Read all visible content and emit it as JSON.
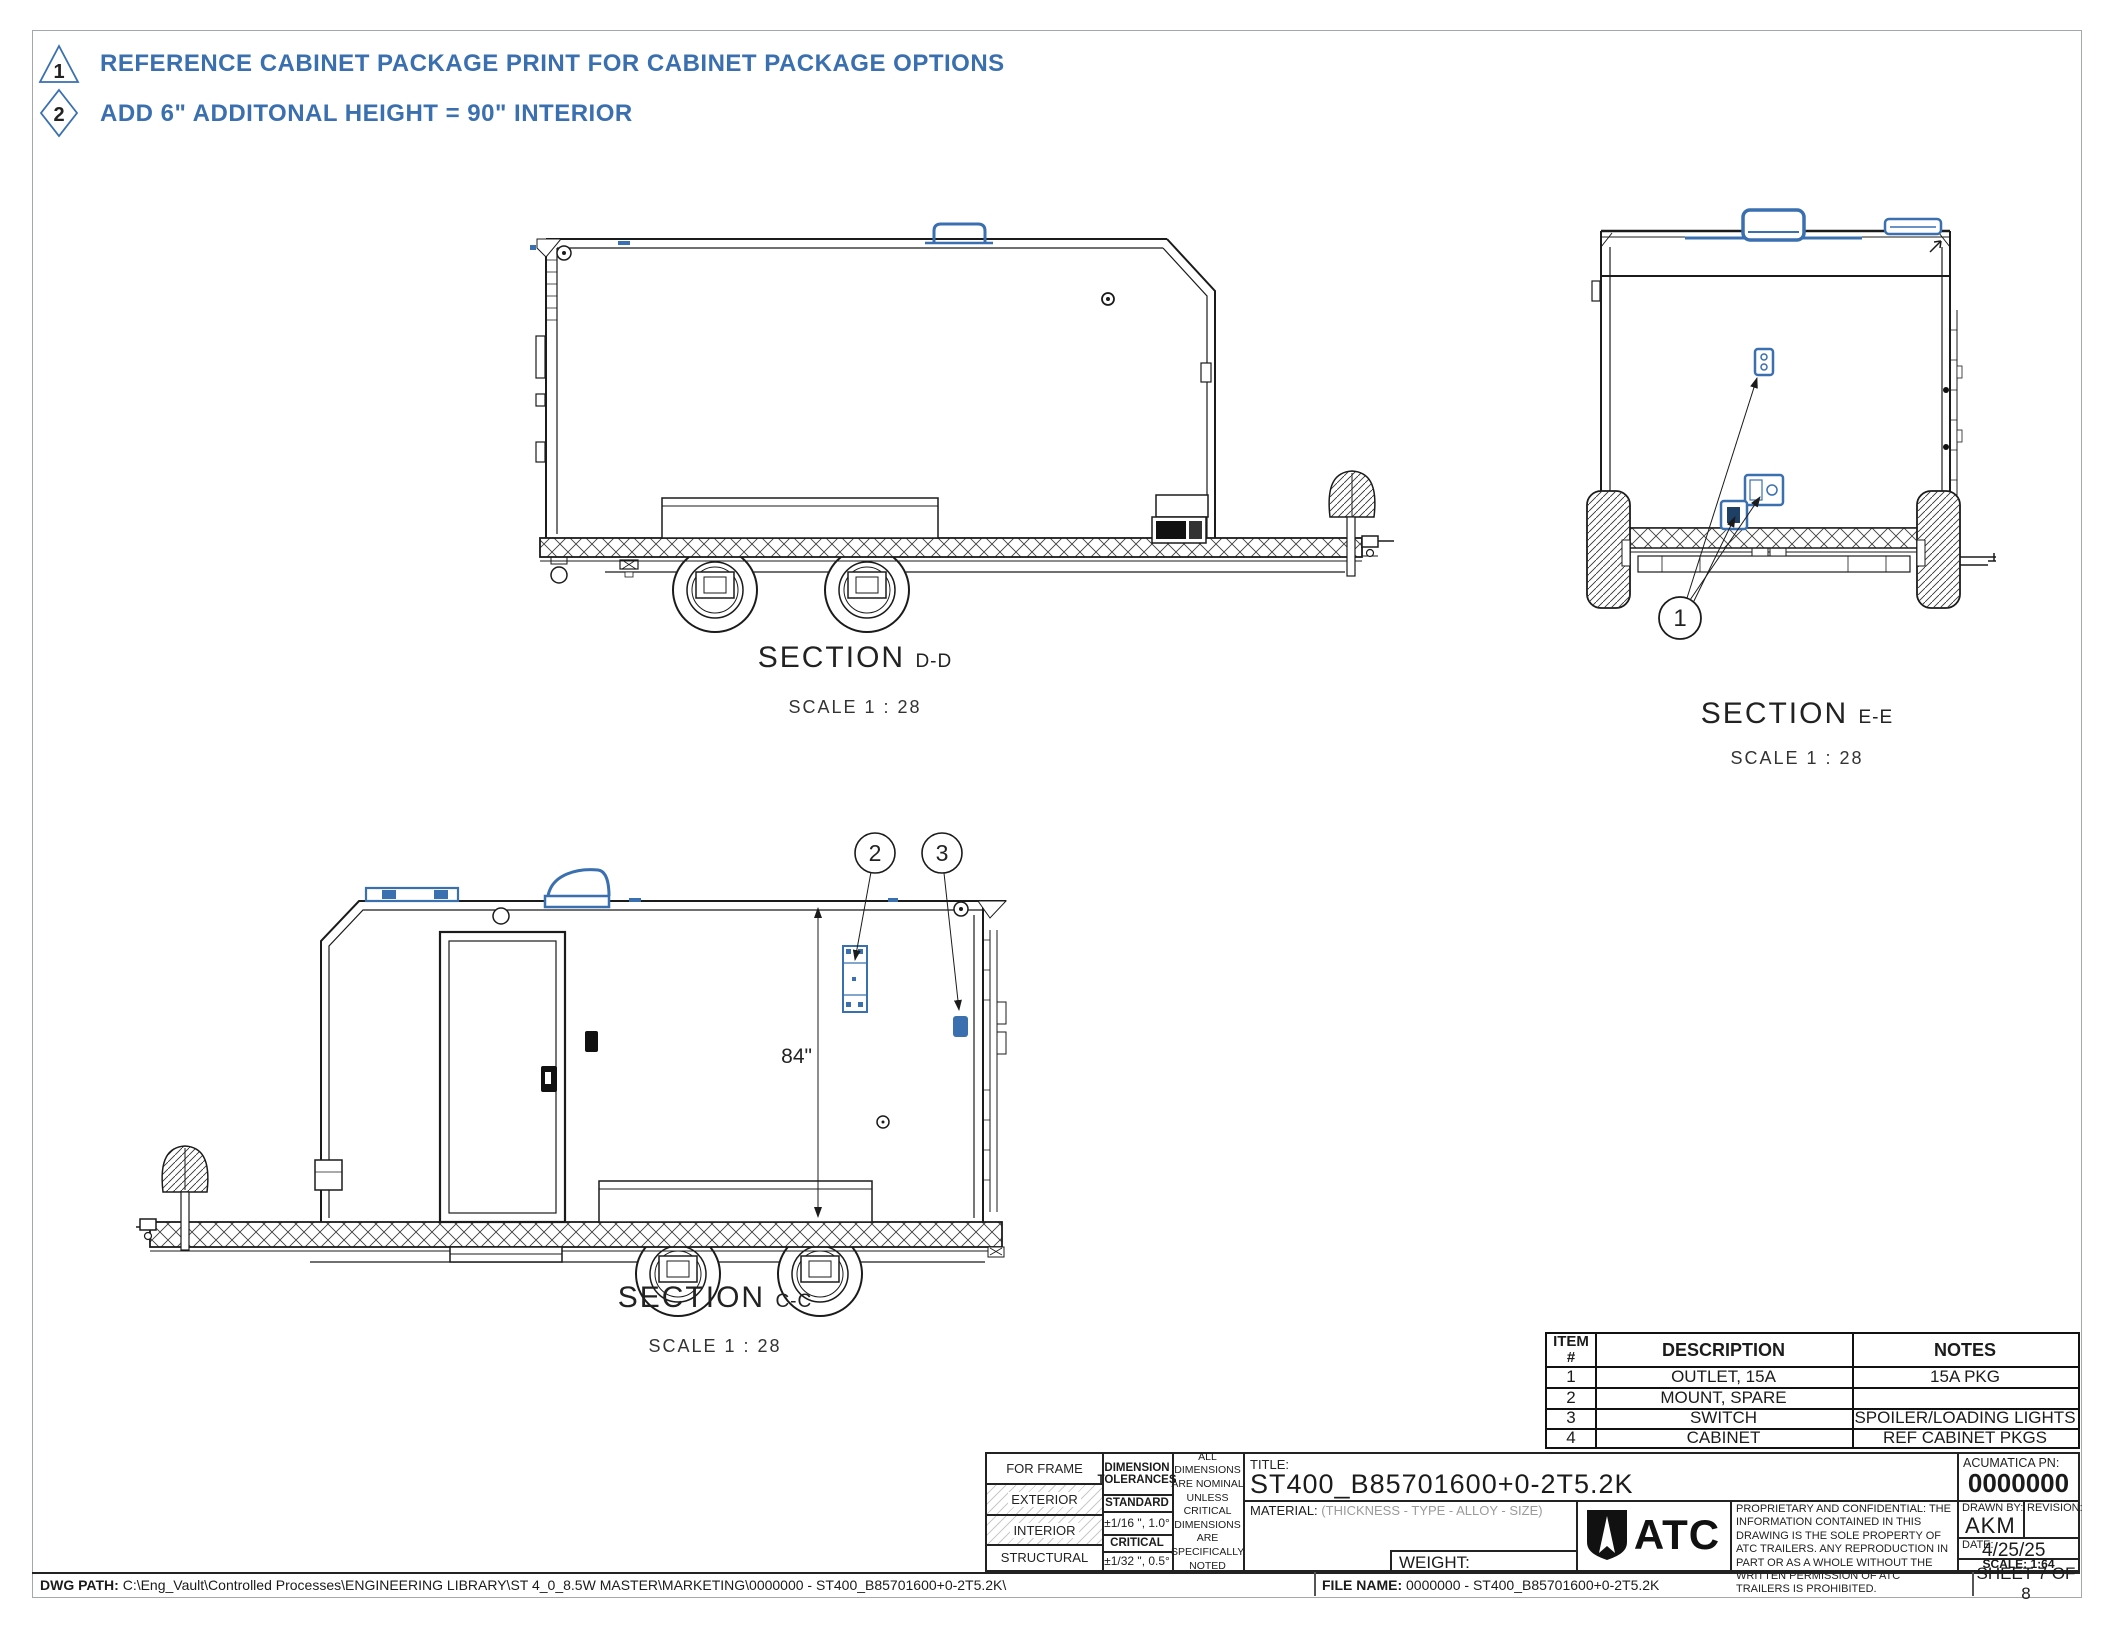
{
  "page": {
    "bg": "#ffffff",
    "border_color": "#a3a8ad"
  },
  "colors": {
    "accent_blue": "#3a6fb0",
    "line_dark": "#1b1b1b"
  },
  "flag_notes": [
    {
      "flag": "1",
      "shape": "triangle",
      "text": "REFERENCE CABINET PACKAGE PRINT FOR CABINET PACKAGE OPTIONS"
    },
    {
      "flag": "2",
      "shape": "diamond",
      "text": "ADD 6\" ADDITONAL HEIGHT = 90\" INTERIOR"
    }
  ],
  "sections": {
    "dd": {
      "label": "SECTION",
      "suffix": "D-D",
      "scale": "SCALE 1 : 28"
    },
    "ee": {
      "label": "SECTION",
      "suffix": "E-E",
      "scale": "SCALE 1 : 28"
    },
    "cc": {
      "label": "SECTION",
      "suffix": "C-C",
      "scale": "SCALE 1 : 28"
    }
  },
  "dimensions": {
    "interior_height": "84\""
  },
  "balloons": {
    "b1": "1",
    "b2": "2",
    "b3": "3"
  },
  "items_table": {
    "header_item": "ITEM",
    "header_item_sub": "#",
    "header_description": "DESCRIPTION",
    "header_notes": "NOTES",
    "rows": [
      {
        "item": "1",
        "description": "OUTLET, 15A",
        "notes": "15A PKG"
      },
      {
        "item": "2",
        "description": "MOUNT, SPARE",
        "notes": ""
      },
      {
        "item": "3",
        "description": "SWITCH",
        "notes": "SPOILER/LOADING LIGHTS"
      },
      {
        "item": "4",
        "description": "CABINET",
        "notes": "REF CABINET PKGS"
      }
    ]
  },
  "title_block": {
    "row_for_frame": "FOR FRAME",
    "row_exterior": "EXTERIOR",
    "row_interior": "INTERIOR",
    "row_structural": "STRUCTURAL",
    "dimension_tolerances": "DIMENSION TOLERANCES",
    "standard_label": "STANDARD",
    "standard_value": "±1/16 \", 1.0°",
    "critical_label": "CRITICAL",
    "critical_value": "±1/32 \", 0.5°",
    "nominal_note": "ALL DIMENSIONS ARE NOMINAL UNLESS CRITICAL DIMENSIONS ARE SPECIFICALLY NOTED",
    "title_label": "TITLE:",
    "title_value": "ST400_B85701600+0-2T5.2K",
    "material_label": "MATERIAL:",
    "material_value": "(THICKNESS - TYPE - ALLOY - SIZE)",
    "weight_label": "WEIGHT:",
    "logo_text": "ATC",
    "proprietary_note": "PROPRIETARY AND CONFIDENTIAL: THE INFORMATION CONTAINED IN THIS DRAWING IS THE SOLE PROPERTY OF ATC TRAILERS. ANY REPRODUCTION IN PART OR AS A WHOLE WITHOUT THE WRITTEN PERMISSION OF ATC TRAILERS IS PROHIBITED.",
    "acumatica_label": "ACUMATICA PN:",
    "acumatica_value": "0000000",
    "drawn_by_label": "DRAWN BY:",
    "drawn_by_value": "AKM",
    "revision_label": "REVISION:",
    "date_label": "DATE:",
    "date_value": "4/25/25",
    "scale_label": "SCALE: 1:64"
  },
  "footer": {
    "dwg_path_label": "DWG PATH:",
    "dwg_path_value": "C:\\Eng_Vault\\Controlled Processes\\ENGINEERING LIBRARY\\ST 4_0_8.5W MASTER\\MARKETING\\0000000 - ST400_B85701600+0-2T5.2K\\",
    "file_name_label": "FILE NAME:",
    "file_name_value": "0000000 - ST400_B85701600+0-2T5.2K",
    "sheet_label": "SHEET 7 OF 8"
  }
}
